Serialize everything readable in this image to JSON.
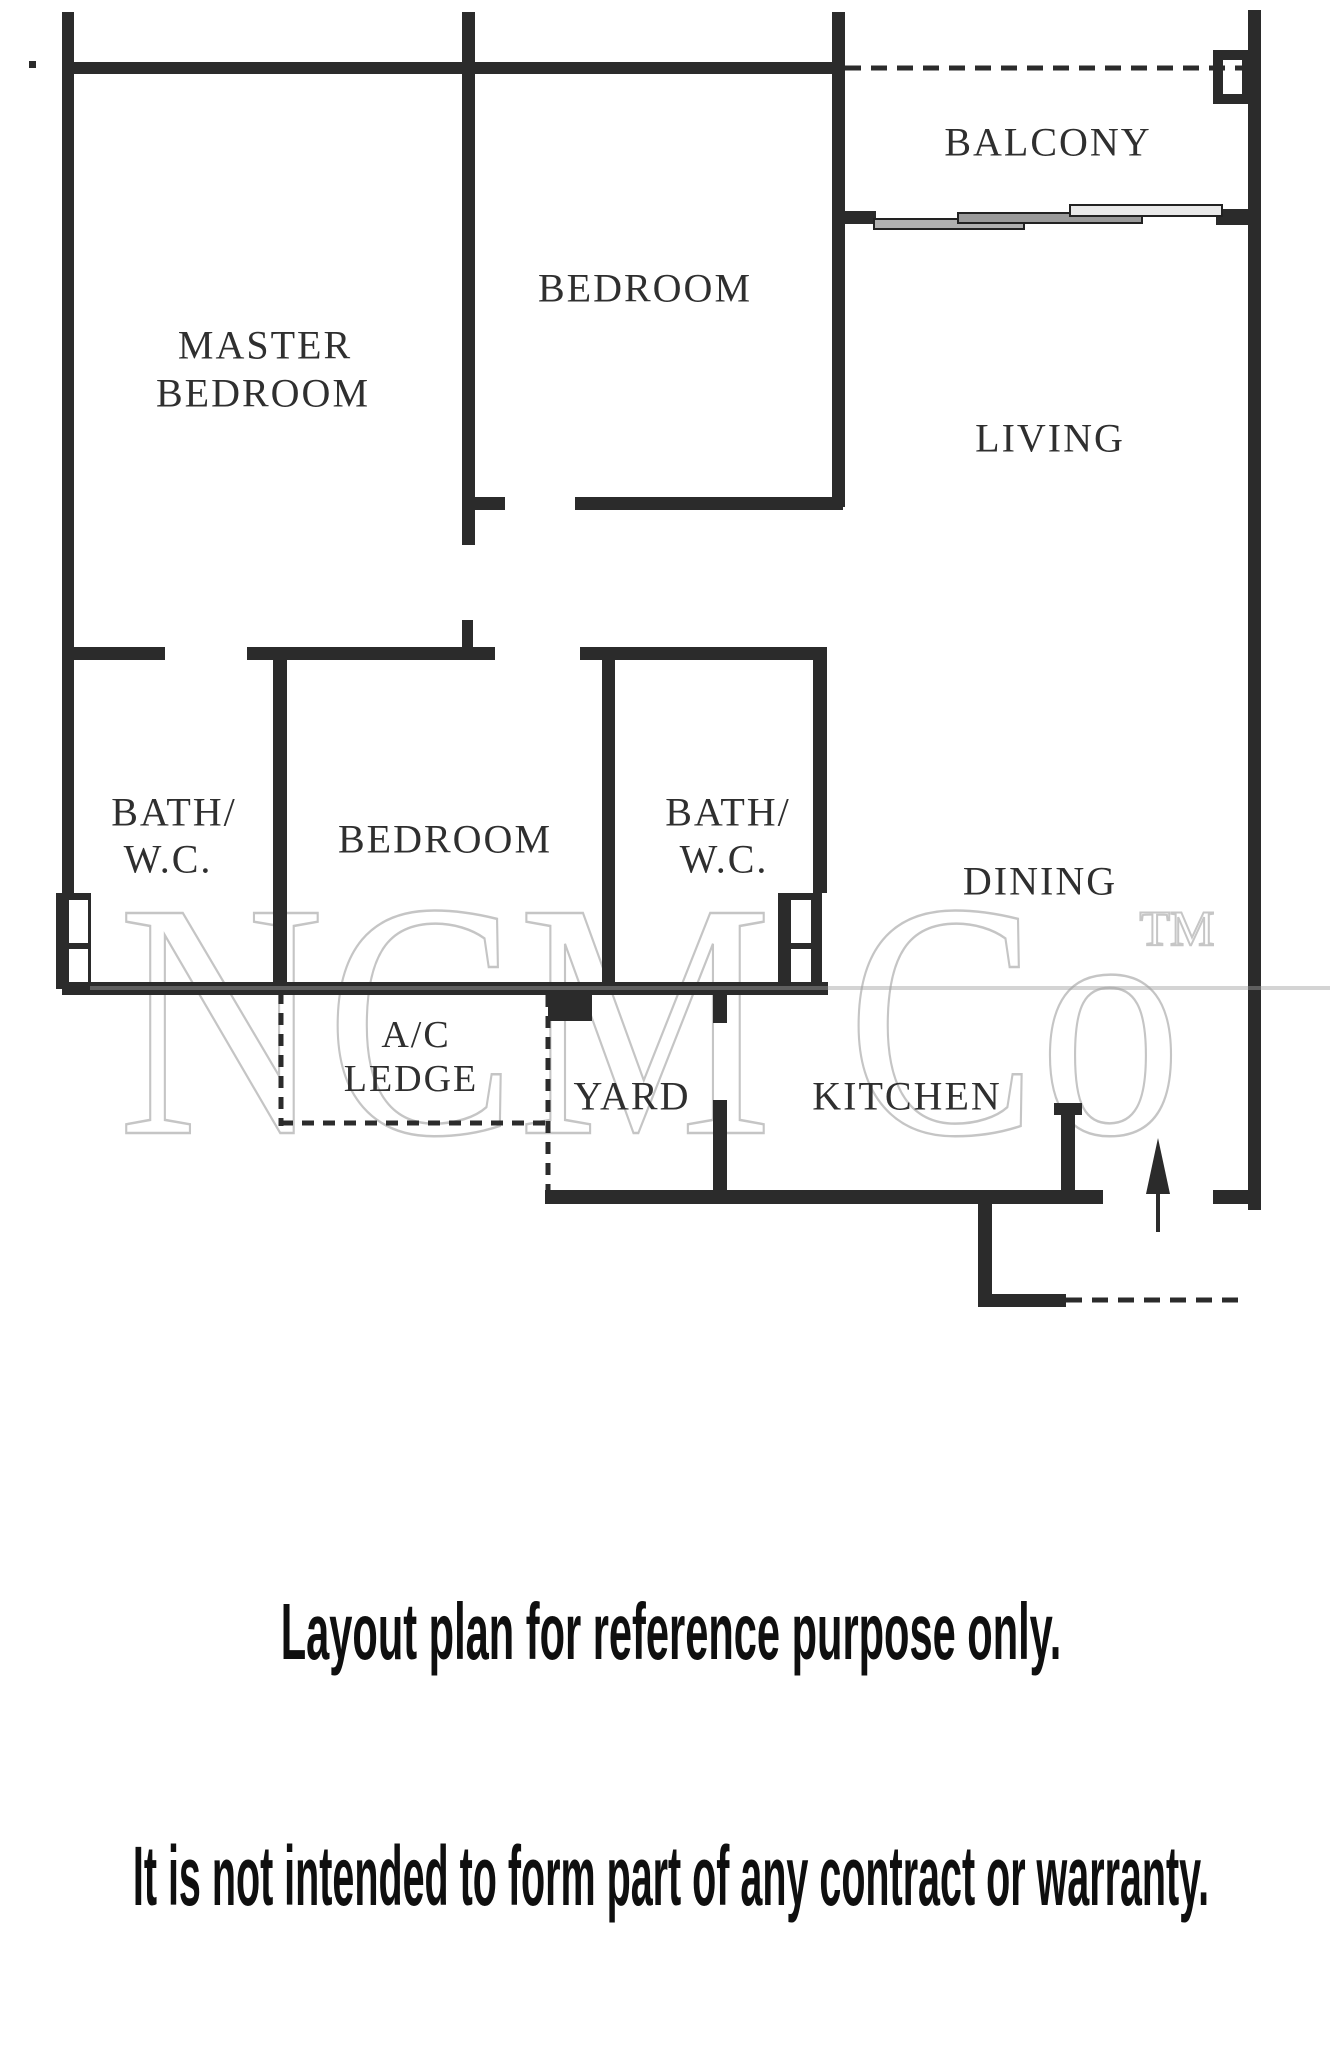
{
  "floor_plan": {
    "colors": {
      "wall": "#2b2b2b",
      "label": "#2f2f2f",
      "caption": "#0f0f0f",
      "watermark_stroke": "#999999"
    },
    "rooms": {
      "master_bedroom": {
        "line1": "MASTER",
        "line2": "BEDROOM"
      },
      "bedroom_top": {
        "label": "BEDROOM"
      },
      "balcony": {
        "label": "BALCONY"
      },
      "living": {
        "label": "LIVING"
      },
      "bath_wc_left": {
        "line1": "BATH/",
        "line2": "W.C."
      },
      "bedroom_middle": {
        "label": "BEDROOM"
      },
      "bath_wc_right": {
        "line1": "BATH/",
        "line2": "W.C."
      },
      "dining": {
        "label": "DINING"
      },
      "ac_ledge": {
        "line1": "A/C",
        "line2": "LEDGE"
      },
      "yard": {
        "label": "YARD"
      },
      "kitchen": {
        "label": "KITCHEN"
      }
    },
    "watermark": {
      "text": "NCM Co",
      "tm": "TM"
    },
    "captions": {
      "line1": "Layout plan for reference purpose only.",
      "line2": "It is not intended to form part of any contract or warranty."
    }
  }
}
